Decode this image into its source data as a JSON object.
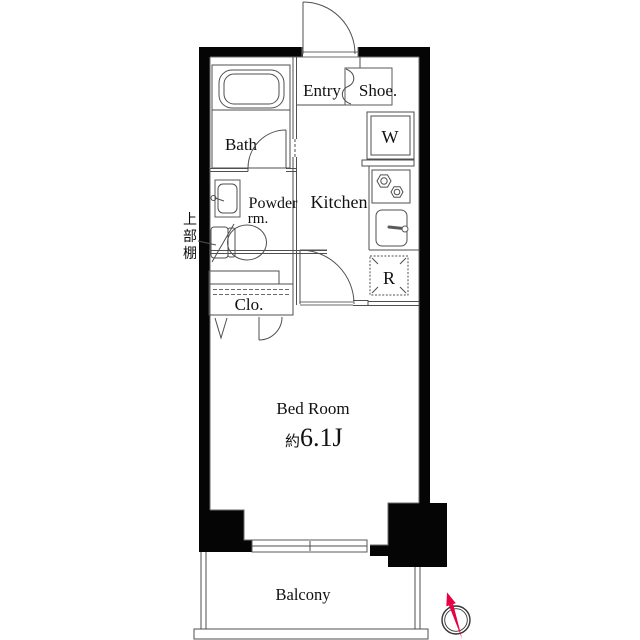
{
  "plan": {
    "type": "apartment-floor-plan",
    "labels": {
      "entry": "Entry",
      "shoe": "Shoe.",
      "bath": "Bath",
      "washer": "W",
      "kitchen": "Kitchen",
      "powder_line1": "Powder",
      "powder_line2": "rm.",
      "fridge": "R",
      "closet": "Clo.",
      "upper_shelf": [
        "上",
        "部",
        "棚"
      ],
      "bedroom": "Bed Room",
      "size_prefix": "約",
      "size_value": "6.1J",
      "balcony": "Balcony"
    },
    "colors": {
      "wall": "#050505",
      "line": "#4f4f4f",
      "compass_red": "#e60044",
      "text": "#111111"
    }
  }
}
